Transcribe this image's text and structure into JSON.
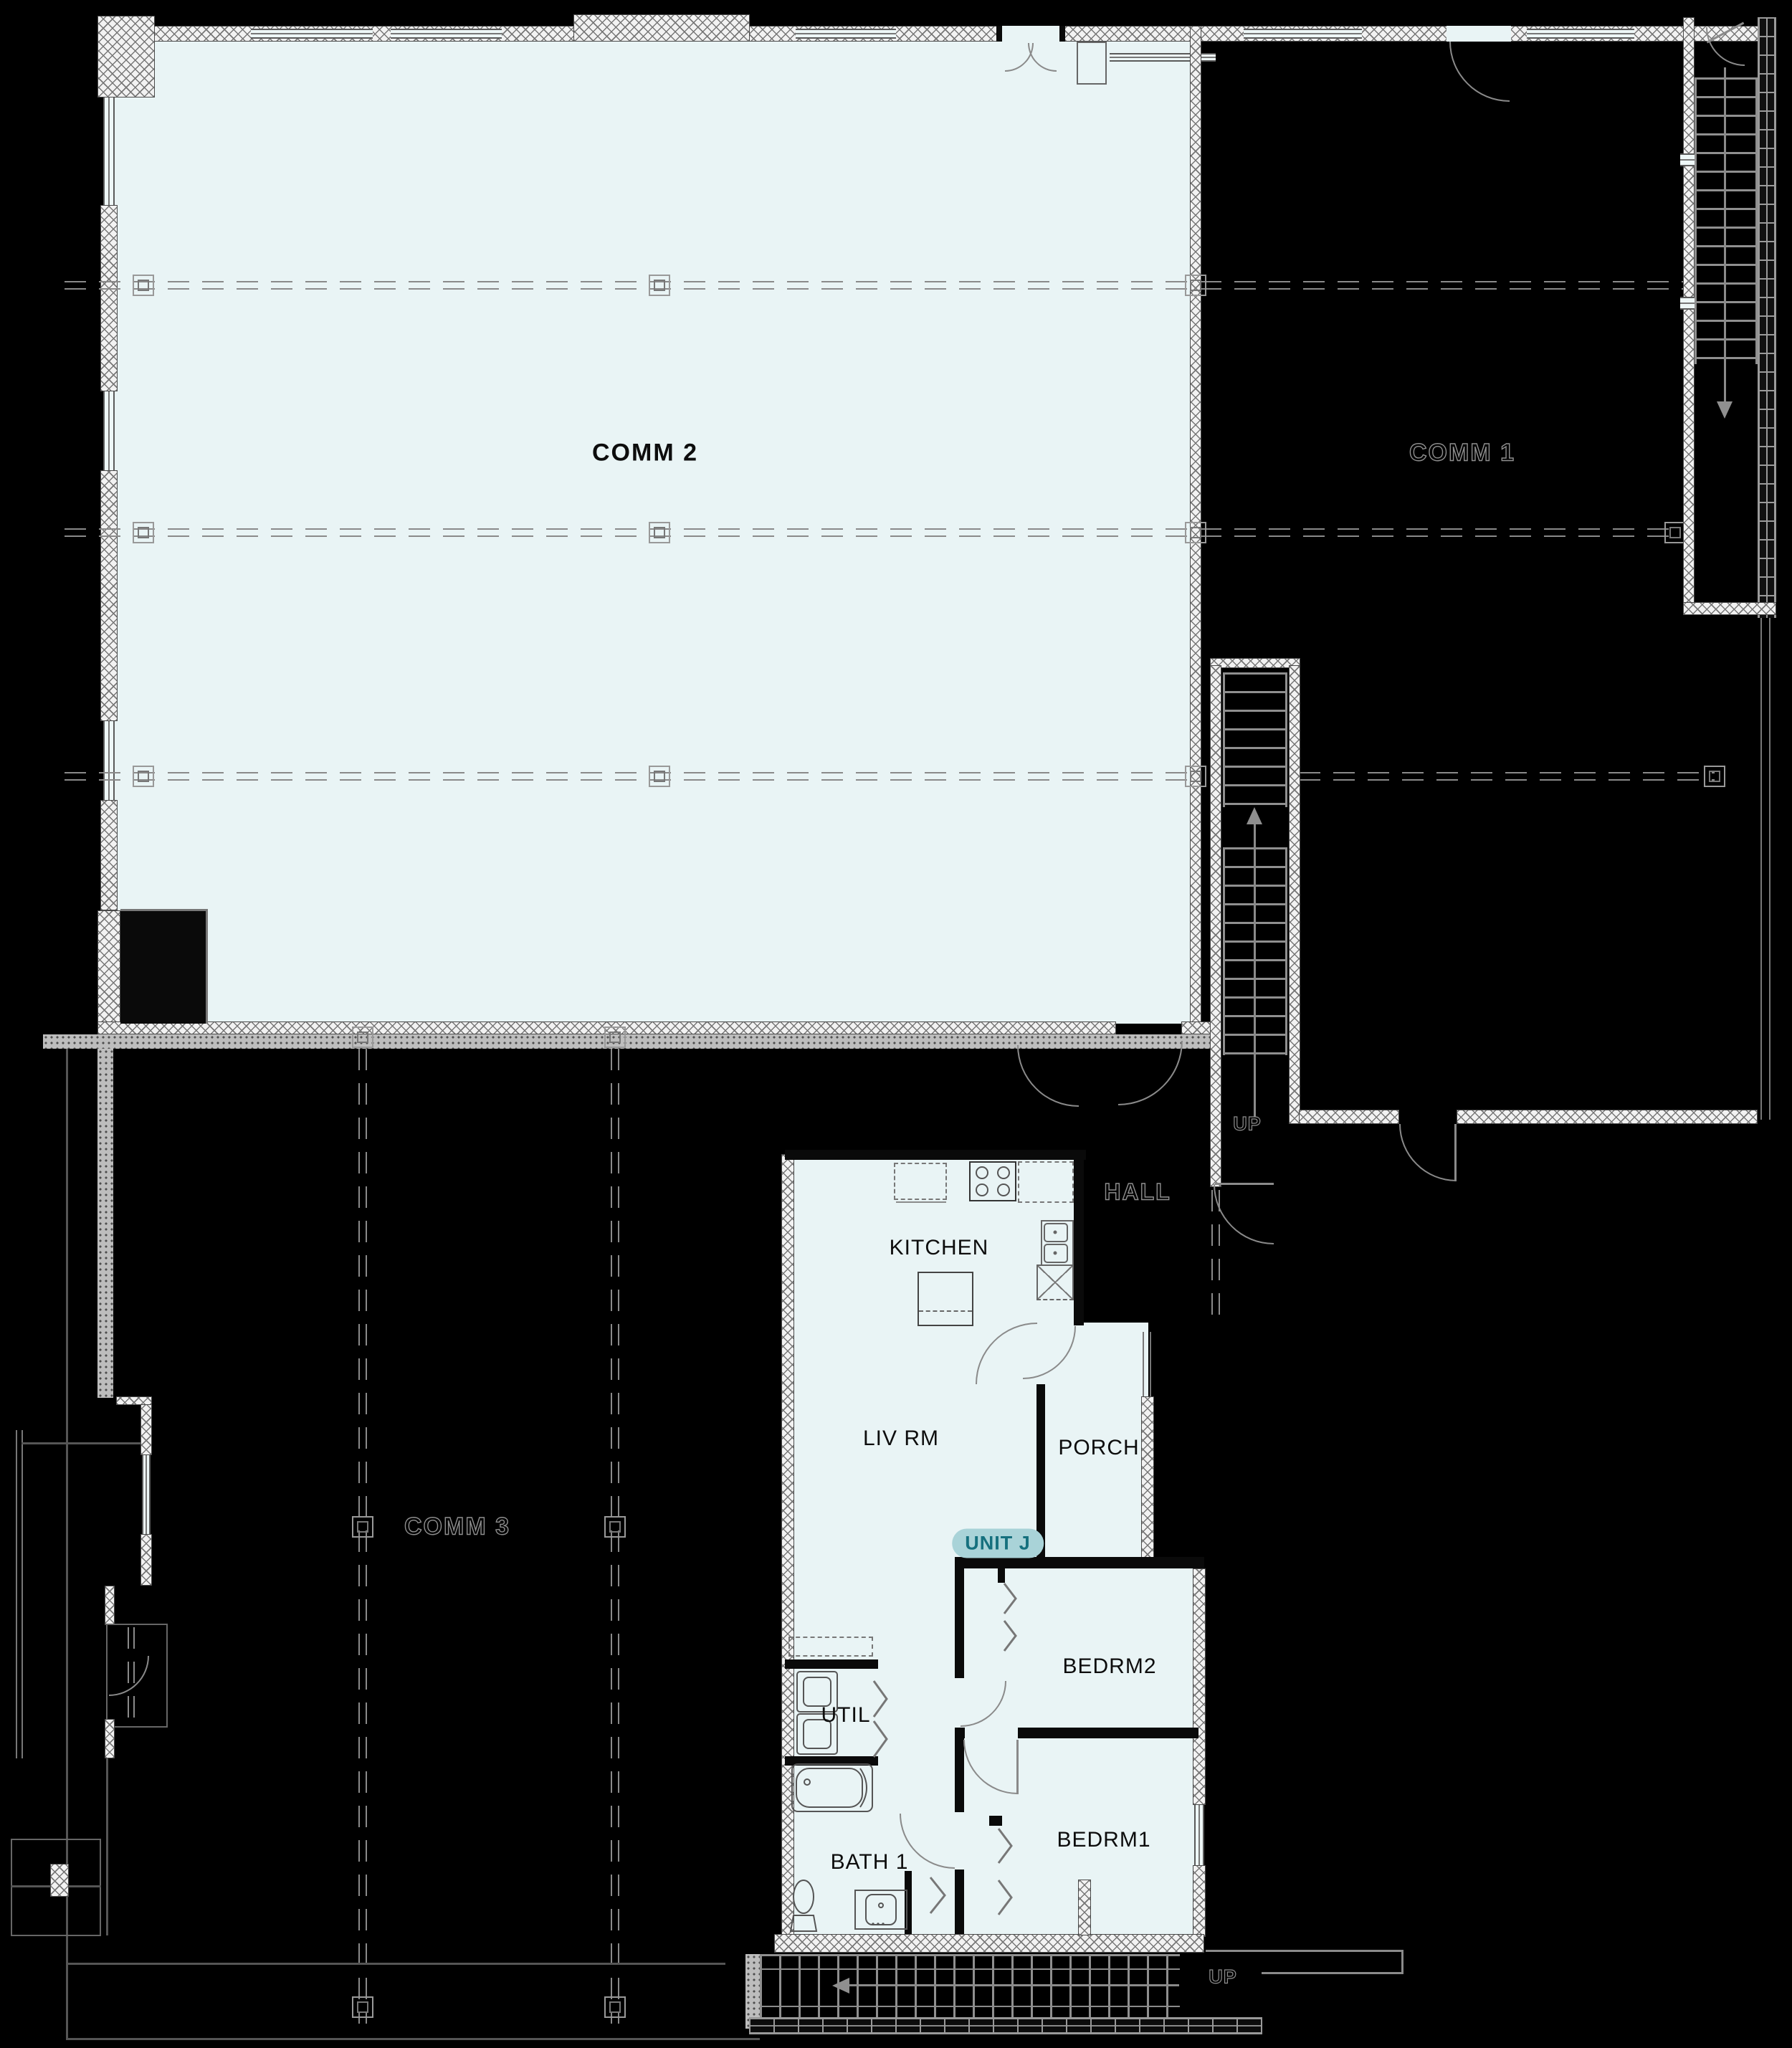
{
  "floorplan": {
    "badge": {
      "unit": "UNIT J"
    },
    "rooms": {
      "comm2": "COMM 2",
      "comm1": "COMM 1",
      "comm3": "COMM 3",
      "kitchen": "KITCHEN",
      "living": "LIV RM",
      "porch": "PORCH",
      "hall": "HALL",
      "bedrm2": "BEDRM2",
      "bedrm1": "BEDRM1",
      "util": "UTIL",
      "bath1": "BATH 1"
    },
    "stairs": {
      "mid_up": "UP",
      "bottom_up": "UP"
    },
    "colors": {
      "background": "#000000",
      "floor_fill": "#e9f4f5",
      "badge_bg": "#a9d3d8",
      "badge_text": "#15707e",
      "outline_text": "#8f8f8f"
    }
  }
}
